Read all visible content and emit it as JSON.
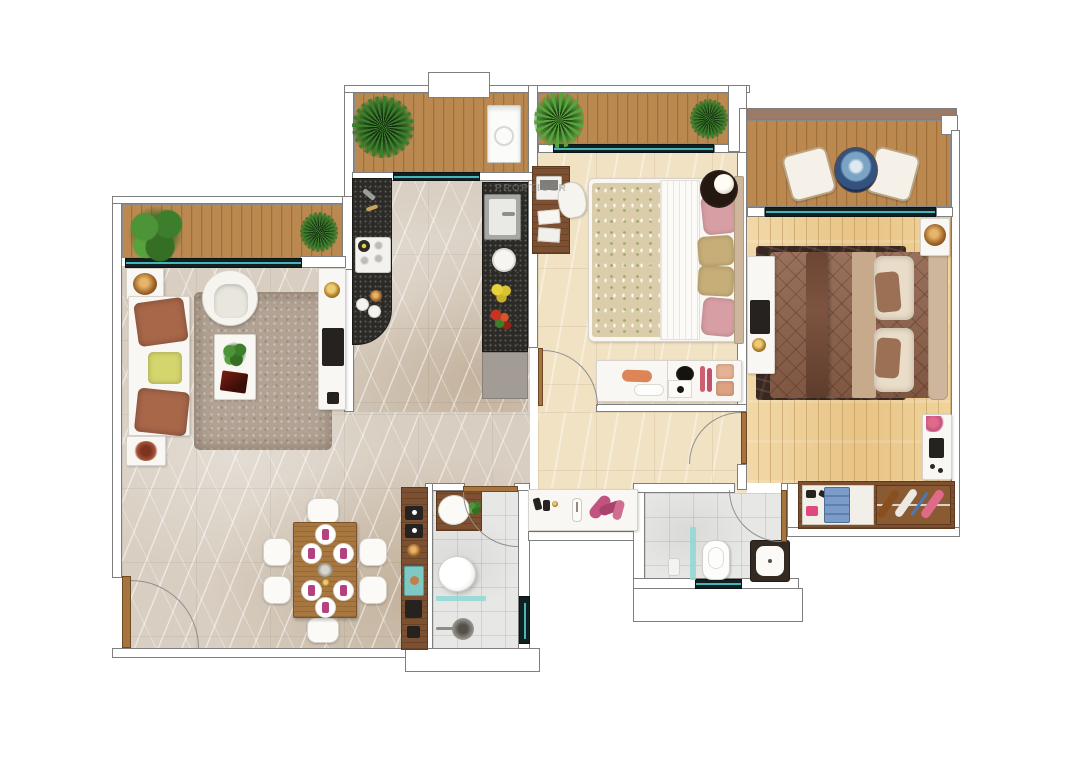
{
  "watermark": {
    "text": "PROPTIGER"
  },
  "palette": {
    "deck-wood": "#bb8950",
    "deck-wood-dark": "#a06f3a",
    "sill-dark": "#132022",
    "sill-teal": "#4fd2d2",
    "marble-base": "#d8cec1",
    "cream-base": "#f0e2c3",
    "wood-floor": "#ecd09e",
    "tile-base": "#e7e7e5",
    "granite": "#2c2a26",
    "rug-taupe": "#b1a294",
    "master-rug": "#372921",
    "master-duvet": "#8d6049",
    "bed2-floral": "#dccdaa",
    "table-wood": "#a8763f",
    "napkin": "#b44280",
    "wardrobe-wood": "#7c5030",
    "teal-glass": "#8fd8d6",
    "cushion-brown": "#a9674a",
    "pillow-yellow": "#d5d56d",
    "pillow-pink": "#d79fa4",
    "pillow-gold": "#c7ae78",
    "headboard-tan": "#cdb69c",
    "balcony-cap": "#9b7b68"
  },
  "rooms": [
    {
      "id": "living-dining",
      "furniture": [
        "sofa",
        "armchair",
        "coffee-table",
        "shag-rug",
        "tv-console",
        "dining-table",
        "six-chairs",
        "decor-console"
      ]
    },
    {
      "id": "kitchen",
      "furniture": [
        "hob-counter",
        "sink-counter",
        "fridge-cabinet"
      ]
    },
    {
      "id": "utility-balcony",
      "furniture": [
        "washing-machine",
        "fern-planter"
      ]
    },
    {
      "id": "bedroom-2",
      "furniture": [
        "double-bed",
        "study-desk",
        "chair",
        "bedside-table-lamp",
        "low-dresser"
      ]
    },
    {
      "id": "master-bedroom",
      "furniture": [
        "double-bed",
        "tv-console",
        "nightstand",
        "dresser",
        "wardrobe-shoe-rack",
        "dark-rug"
      ]
    },
    {
      "id": "master-balcony",
      "furniture": [
        "two-chairs",
        "mosaic-table"
      ]
    },
    {
      "id": "living-balcony",
      "furniture": [
        "two-planters"
      ]
    },
    {
      "id": "bedroom-balcony",
      "furniture": [
        "two-planters"
      ]
    },
    {
      "id": "common-bathroom",
      "furniture": [
        "basin-vanity",
        "toilet",
        "shower-partition"
      ]
    },
    {
      "id": "master-bathroom",
      "furniture": [
        "toilet",
        "basin-vanity",
        "shower-partition"
      ]
    }
  ]
}
